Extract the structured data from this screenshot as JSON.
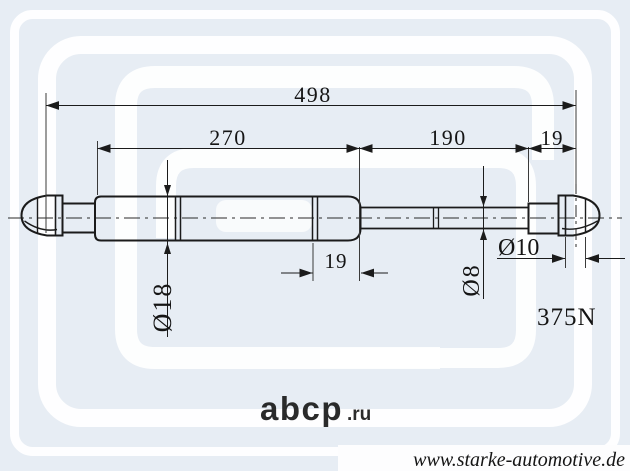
{
  "drawing": {
    "dim_total_length": "498",
    "dim_body_length": "270",
    "dim_rod_length": "190",
    "dim_end_fitting": "19",
    "dim_piston_section": "19",
    "dia_body": "Ø18",
    "dia_rod": "Ø8",
    "dia_eye": "Ø10",
    "force_rating": "375N"
  },
  "watermarks": {
    "portal_name": "abcp",
    "portal_tld": ".ru"
  },
  "footer": {
    "website": "www.starke-automotive.de"
  },
  "colors": {
    "background": "#e7edf4",
    "watermark": "#ffffff",
    "line_color": "#1b1b1b",
    "footer_text": "#14142b",
    "portal_text": "#bdc2cc"
  }
}
